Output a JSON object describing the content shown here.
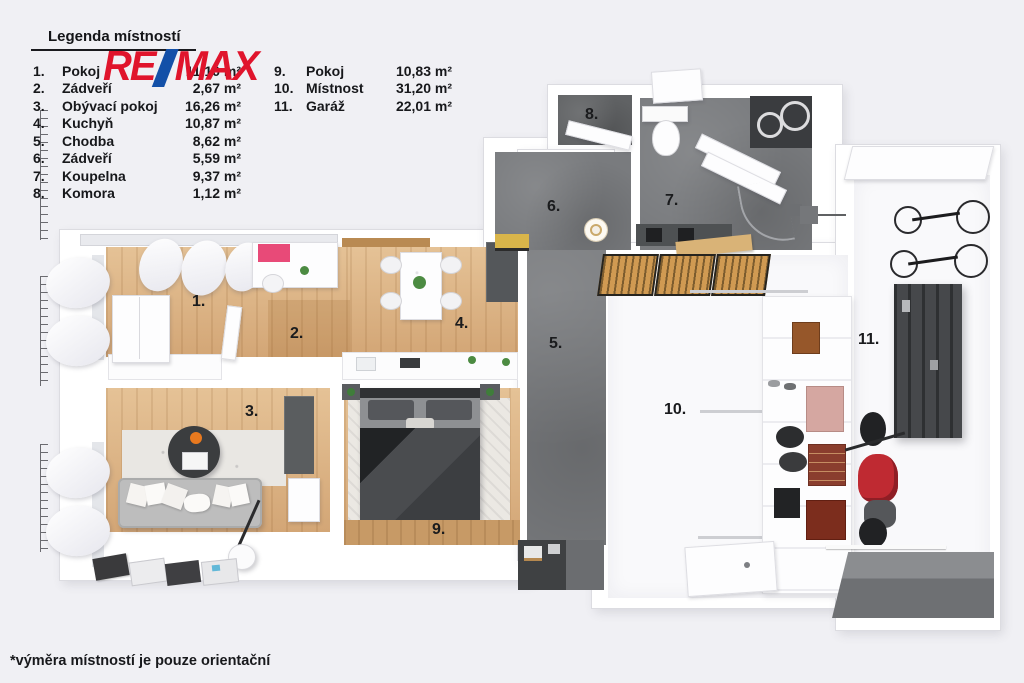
{
  "legend": {
    "title": "Legenda místností",
    "items": [
      {
        "num": "1.",
        "name": "Pokoj",
        "area": "11,10 m²"
      },
      {
        "num": "2.",
        "name": "Zádveří",
        "area": "2,67 m²"
      },
      {
        "num": "3.",
        "name": "Obývací pokoj",
        "area": "16,26 m²"
      },
      {
        "num": "4.",
        "name": "Kuchyň",
        "area": "10,87 m²"
      },
      {
        "num": "5.",
        "name": "Chodba",
        "area": "8,62 m²"
      },
      {
        "num": "6.",
        "name": "Zádveří",
        "area": "5,59 m²"
      },
      {
        "num": "7.",
        "name": "Koupelna",
        "area": "9,37 m²"
      },
      {
        "num": "8.",
        "name": "Komora",
        "area": "1,12 m²"
      },
      {
        "num": "9.",
        "name": "Pokoj",
        "area": "10,83 m²"
      },
      {
        "num": "10.",
        "name": "Místnost",
        "area": "31,20 m²"
      },
      {
        "num": "11.",
        "name": "Garáž",
        "area": "22,01 m²"
      }
    ]
  },
  "logo": {
    "re": "RE",
    "slash": "/",
    "max": "MAX",
    "red": "#e0142c",
    "blue": "#1350a8"
  },
  "plan": {
    "labels": [
      "1.",
      "2.",
      "3.",
      "4.",
      "5.",
      "6.",
      "7.",
      "8.",
      "9.",
      "10.",
      "11."
    ],
    "colors": {
      "background": "#f0f0f4",
      "wall": "#ffffff",
      "wood_floor": "#dcb486",
      "gray_floor": "#797b7e",
      "white_floor": "#f9f9fb",
      "motorcycle_red": "#bf2a32",
      "crate_wood": "#d09a52"
    }
  },
  "footnote": "*výměra místností je pouze orientační"
}
